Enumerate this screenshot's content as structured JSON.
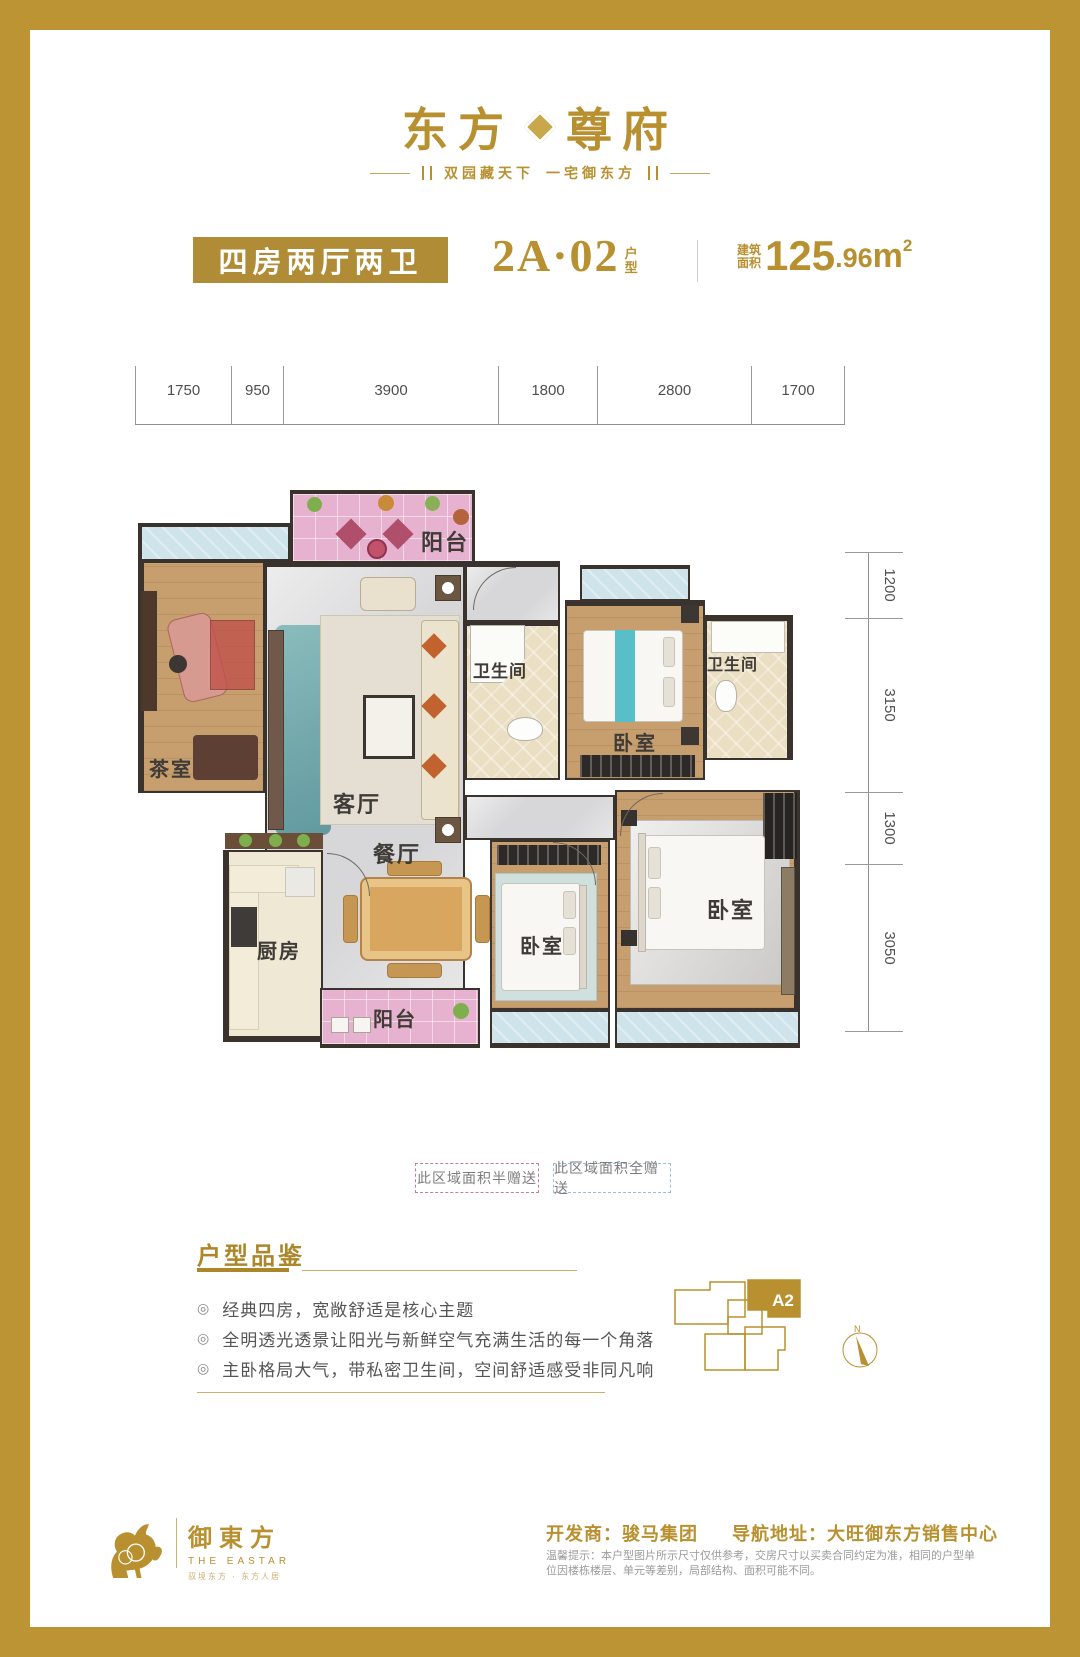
{
  "brand": {
    "logo_left": "东方",
    "logo_right": "尊府",
    "tagline_left": "双园藏天下",
    "tagline_right": "一宅御东方"
  },
  "header": {
    "type_badge": "四房两厅两卫",
    "unit_code": "2A·02",
    "unit_suffix_top": "户",
    "unit_suffix_bottom": "型",
    "area_label_top": "建筑",
    "area_label_bottom": "面积",
    "area_int": "125",
    "area_dec": ".96",
    "area_unit": "m",
    "area_sup": "2"
  },
  "plan": {
    "dims_top": [
      "1750",
      "950",
      "3900",
      "1800",
      "2800",
      "1700"
    ],
    "dims_right": [
      "1200",
      "3150",
      "1300",
      "3050"
    ],
    "rooms": {
      "balcony_top": "阳台",
      "tea_room": "茶室",
      "living": "客厅",
      "bath1": "卫生间",
      "bedroom_top": "卧室",
      "bath2": "卫生间",
      "dining": "餐厅",
      "kitchen": "厨房",
      "balcony_bottom": "阳台",
      "bedroom_mid": "卧室",
      "bedroom_master": "卧室"
    },
    "legend_half": "此区域面积半赠送",
    "legend_full": "此区域面积全赠送"
  },
  "features": {
    "heading": "户型品鉴",
    "bullets": [
      "经典四房，宽敞舒适是核心主题",
      "全明透光透景让阳光与新鲜空气充满生活的每一个角落",
      "主卧格局大气，带私密卫生间，空间舒适感受非同凡响"
    ]
  },
  "keyplan": {
    "unit": "A2",
    "north": "N"
  },
  "footer": {
    "logo_cn": "御東方",
    "logo_en": "THE EASTAR",
    "logo_sub": "驭境东方 · 东方人居",
    "dev": "开发商：骏马集团",
    "nav": "导航地址：大旺御东方销售中心",
    "disclaimer": "温馨提示：本户型图片所示尺寸仅供参考，交房尺寸以买卖合同约定为准，相同的户型单位因楼栋楼层、单元等差别，局部结构、面积可能不同。"
  },
  "colors": {
    "gold": "#b8902f",
    "frame_gold": "#bd9433",
    "balcony_pink": "#e7b2d0",
    "bay_blue": "#cfe4ea",
    "wood": "#c79e6e",
    "marble": "#d7d6d8"
  }
}
